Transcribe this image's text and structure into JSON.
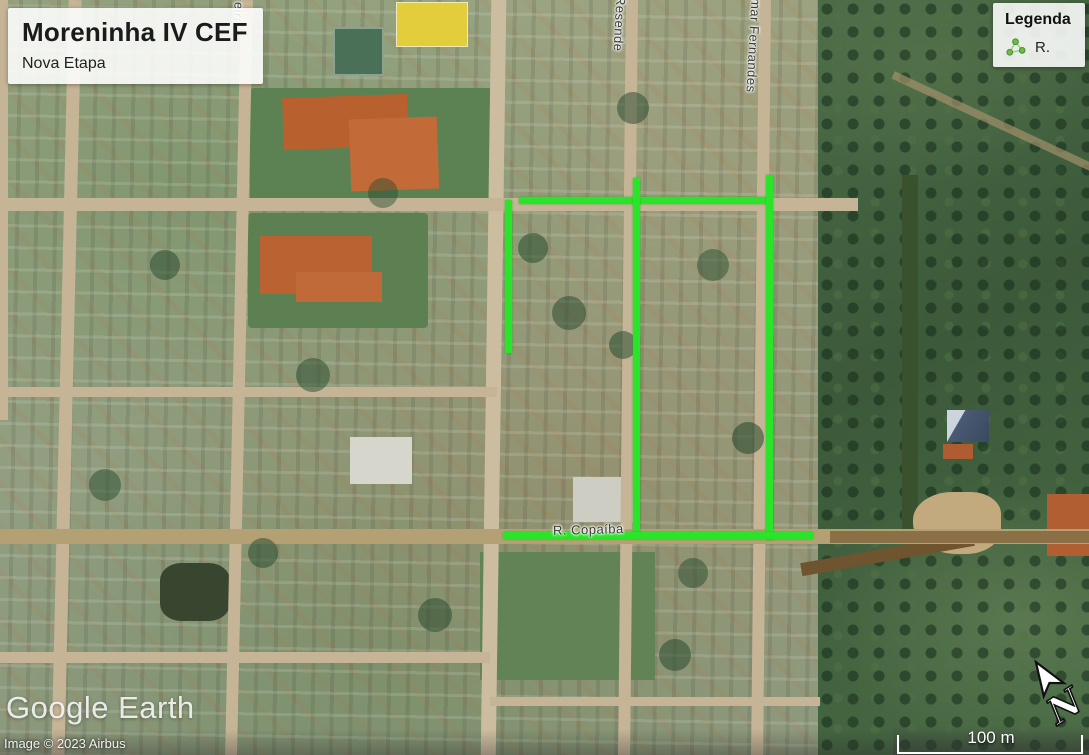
{
  "title_card": {
    "title": "Moreninha IV CEF",
    "subtitle": "Nova Etapa"
  },
  "legend": {
    "title": "Legenda",
    "items": [
      {
        "icon": "path-icon",
        "label": "R."
      }
    ]
  },
  "street_labels": [
    {
      "text": "R. Copaíba",
      "x": 553,
      "y": 522,
      "orientation": "horizontal"
    },
    {
      "text": "Resende",
      "x": 612,
      "y": -4,
      "orientation": "vertical"
    },
    {
      "text": "mar Fernandes",
      "x": 746,
      "y": -2,
      "orientation": "vertical"
    },
    {
      "text": "eira",
      "x": 231,
      "y": 2,
      "orientation": "vertical"
    }
  ],
  "route_overlay": {
    "color": "#2ce32c",
    "segments": [
      {
        "x": 519,
        "y": 197,
        "w": 249,
        "h": 7
      },
      {
        "x": 505,
        "y": 200,
        "w": 7,
        "h": 153
      },
      {
        "x": 633,
        "y": 178,
        "w": 7,
        "h": 360
      },
      {
        "x": 766,
        "y": 175,
        "w": 7,
        "h": 365
      },
      {
        "x": 503,
        "y": 532,
        "w": 310,
        "h": 7
      }
    ]
  },
  "branding": {
    "logo_text": "Google Earth",
    "attribution": "Image © 2023 Airbus"
  },
  "scale_bar": {
    "label": "100 m"
  },
  "north_indicator": {
    "label": "N"
  }
}
